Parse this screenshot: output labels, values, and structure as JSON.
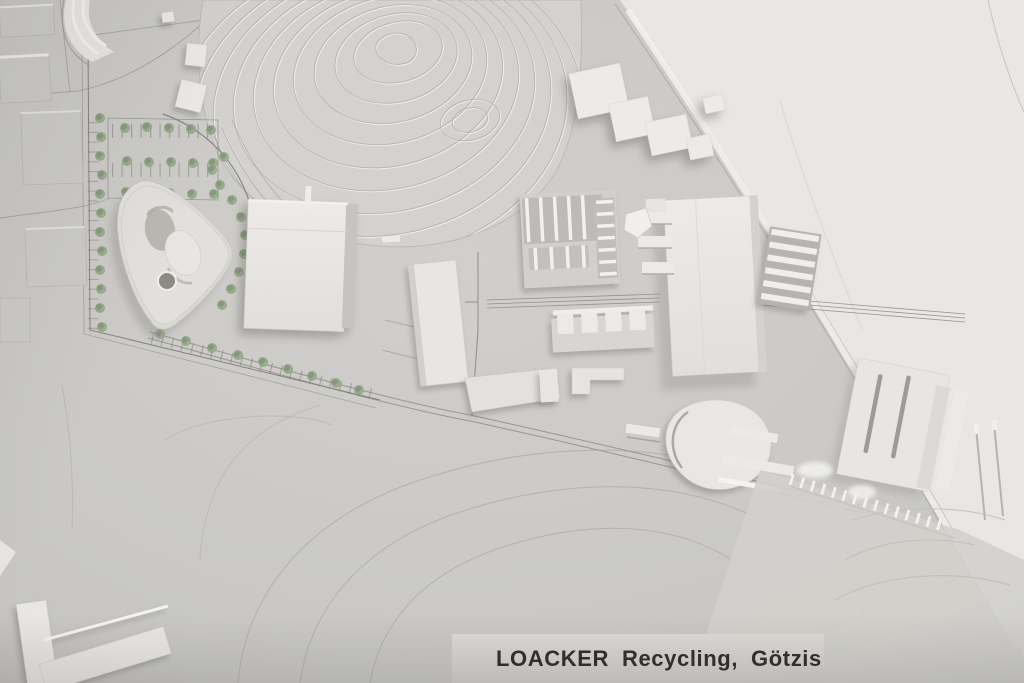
{
  "caption": {
    "brand": "LOACKER",
    "category": "Recycling,",
    "location": "Götzis"
  },
  "palette": {
    "base_gray": "#cac9c6",
    "model_white": "#eceae6",
    "terrain_gray": "#d4d2ce",
    "highway_plate_white": "#e9e7e3",
    "tree_green": "#8ea383",
    "caption_text": "#2f2e2c"
  }
}
